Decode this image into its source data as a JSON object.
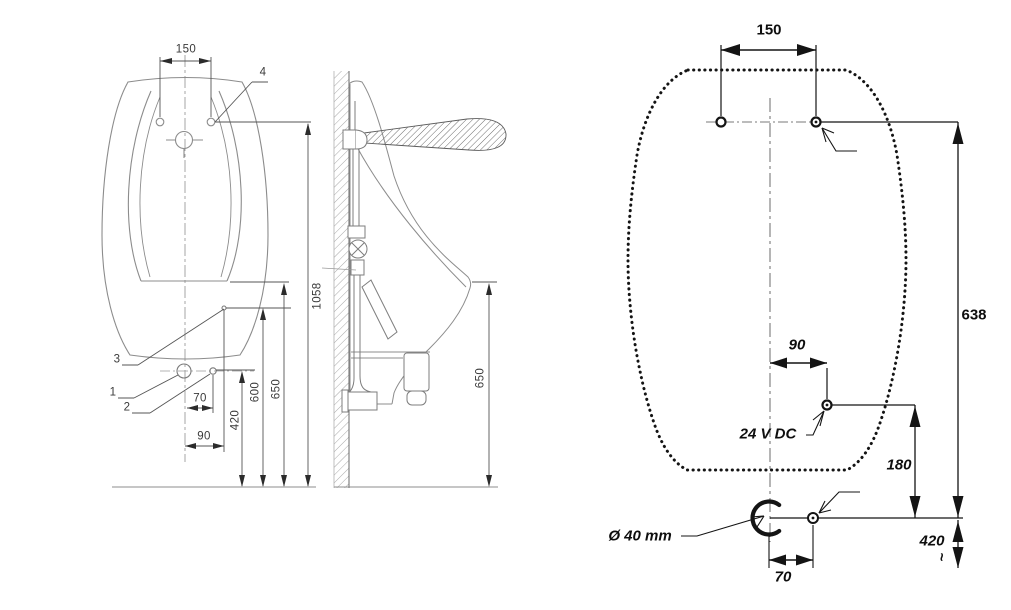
{
  "drawing": {
    "front_view": {
      "dim_150": "150",
      "item_4": "4",
      "item_3": "3",
      "item_1": "1",
      "item_2": "2",
      "dim_70": "70",
      "dim_90": "90",
      "dim_420": "420",
      "dim_600": "600",
      "dim_650": "650",
      "dim_1058": "1058"
    },
    "side_view": {
      "dim_650": "650"
    },
    "template_view": {
      "dim_150": "150",
      "dim_638": "638",
      "dim_90": "90",
      "power_label": "24 V DC",
      "dim_180": "180",
      "drain_label": "Ø 40 mm",
      "dim_70": "70",
      "dim_420": "420",
      "approx_symbol": "~"
    },
    "colors": {
      "body_line": "#8c8c8c",
      "dim_line": "#4a4a4a",
      "template_line": "#141414",
      "background": "#ffffff"
    }
  }
}
